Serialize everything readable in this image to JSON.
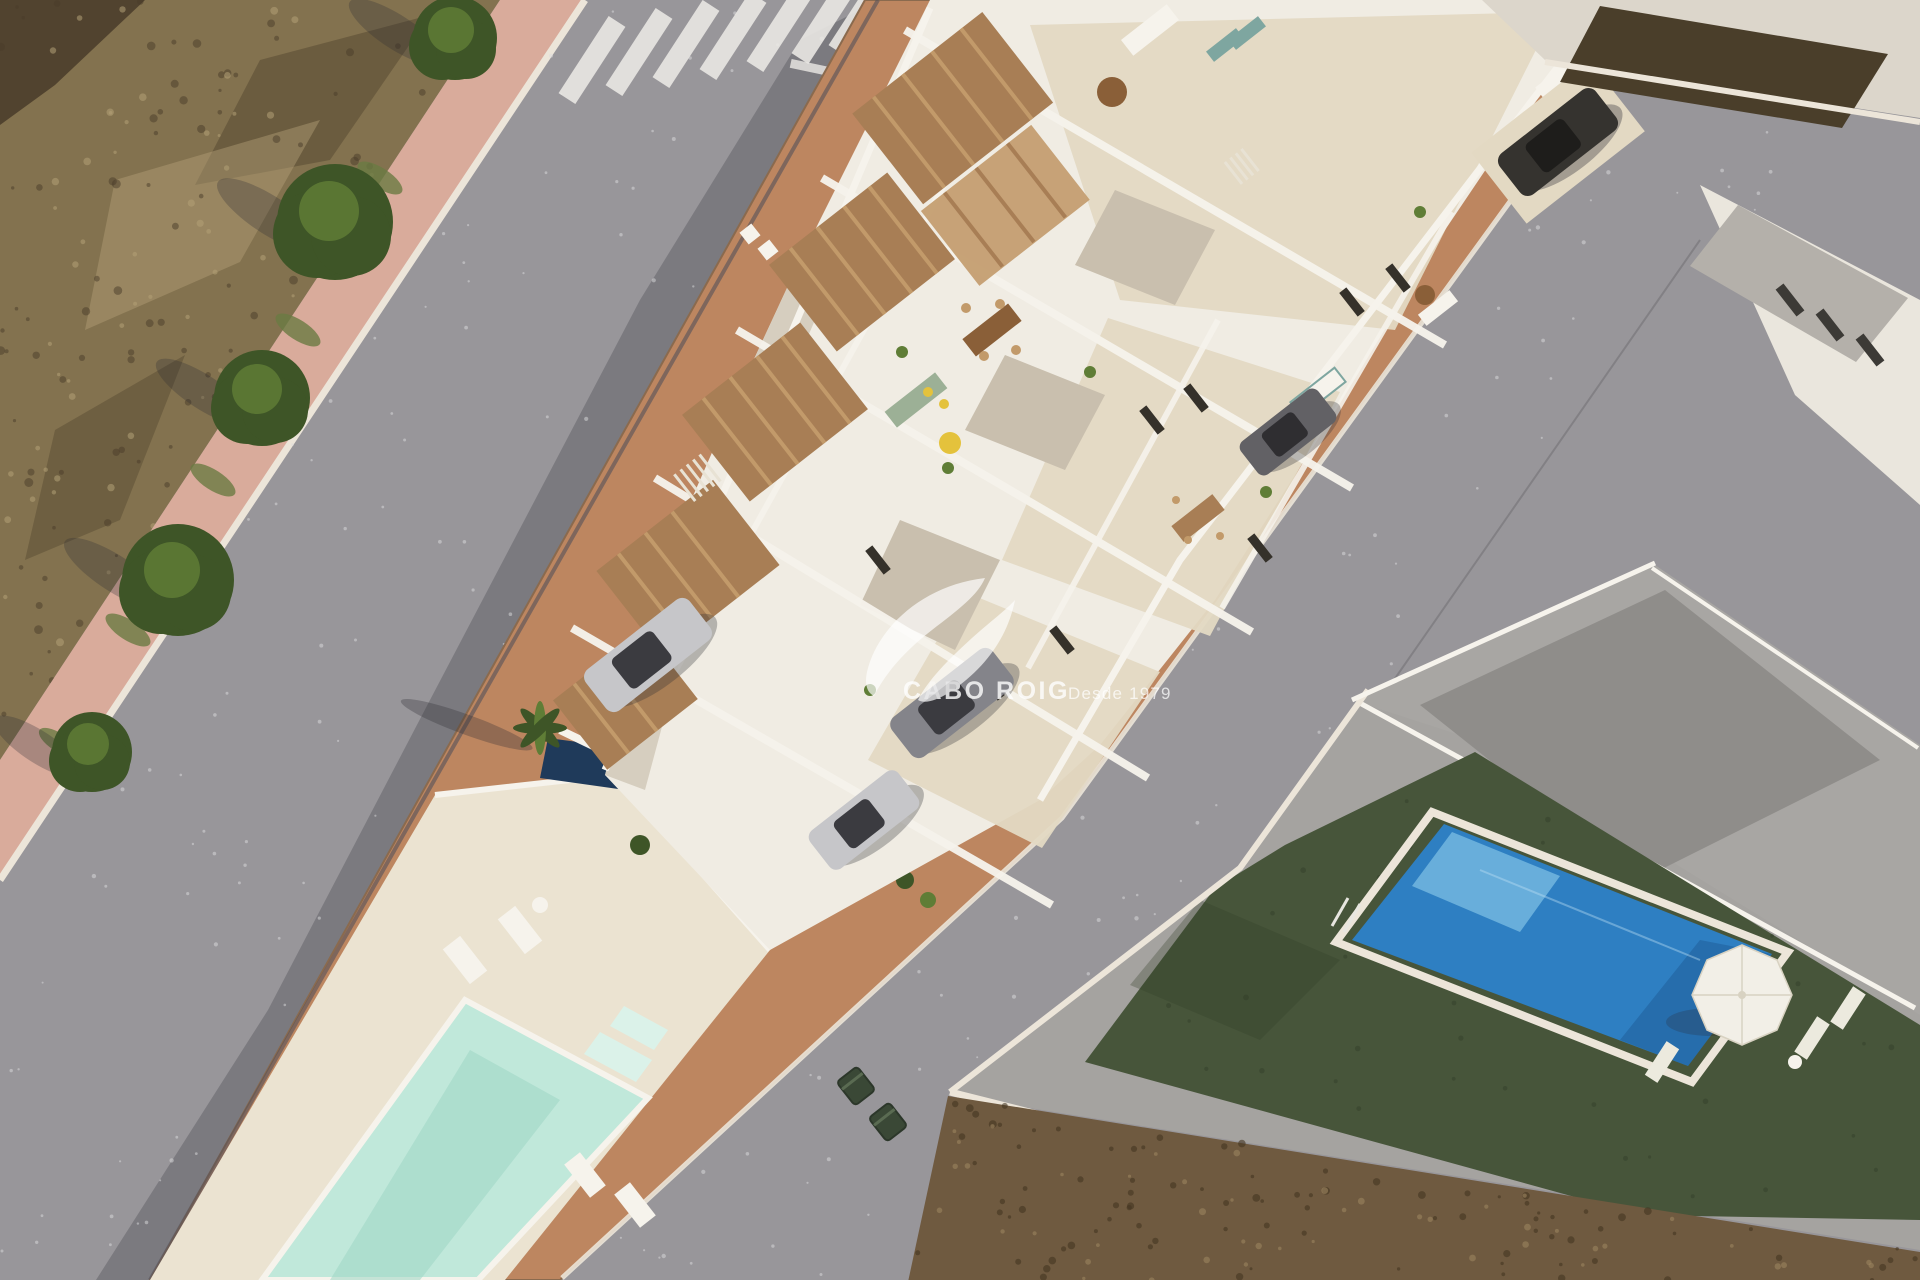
{
  "watermark": {
    "brand": "CABO ROIG",
    "tagline": "Desde 1979"
  },
  "scene": {
    "type": "aerial-3d-architectural-render",
    "areas": [
      "dry-scrubland-lot",
      "pink-sidewalk-with-trees",
      "asphalt-road-with-crosswalk",
      "new-townhouse-block-roof-terraces",
      "terracotta-perimeter-paving",
      "triangular-communal-pool",
      "sun-deck-with-loungers",
      "neighbor-villa-turf-garden",
      "blue-swimming-pool",
      "white-parasol",
      "vacant-dirt-lot",
      "existing-buildings"
    ],
    "tree_count": 5,
    "car_count": 5,
    "bin_count": 2
  },
  "palette": {
    "asphalt": "#98969a",
    "asphaltDark": "#2c2c33",
    "speckleLight": "#dcdcde",
    "curb": "#ece5d9",
    "sidewalk": "#d9ab9b",
    "scrub": "#83724f",
    "scrubDark": "#493b29",
    "scrubLight": "#b3a077",
    "grass": "#6a7a42",
    "treeGreen": "#3e5527",
    "treeGreenLight": "#5f7d36",
    "trunk": "#4a3520",
    "stripe": "#eceae6",
    "terracotta": "#bd8660",
    "terracottaEdge": "#93603f",
    "devWhite": "#f0ece3",
    "devShade": "#d6cebf",
    "patio": "#c9bfae",
    "terrace": "#e3d9c3",
    "wood": "#a87e55",
    "woodLight": "#c29a6a",
    "woodDark": "#8a5f38",
    "opening": "#35312a",
    "mint": "#c0e8da",
    "mintDeep": "#9cd6c4",
    "mintStep": "#dbf2e9",
    "deckCream": "#ebe3d1",
    "navy": "#1f3a5a",
    "turf": "#47553a",
    "turfDark": "#333f29",
    "poolBlue": "#2e7fc2",
    "poolBlueLight": "#6fb4de",
    "poolBlueDeep": "#1d5c96",
    "umbrella": "#f2efe7",
    "bldgCream": "#dcd6cb",
    "roofDark": "#524d45",
    "bldgWhite": "#eae6dd",
    "roofGray": "#b4b0aa",
    "hedge": "#4a3e2a",
    "dirt": "#6f5a40",
    "dirtDark": "#443522",
    "dirtLight": "#9b845f",
    "carSilver": "#c6c6c9",
    "carGray": "#84848a",
    "carDarkGray": "#626165",
    "carBlack": "#35332f",
    "glass": "#3b3b40",
    "bin": "#3a4836",
    "white": "#f6f3ec",
    "sage": "#9cb096",
    "yellow": "#e4c23c",
    "teal": "#7ea6a0",
    "watermark": "#ffffff"
  }
}
